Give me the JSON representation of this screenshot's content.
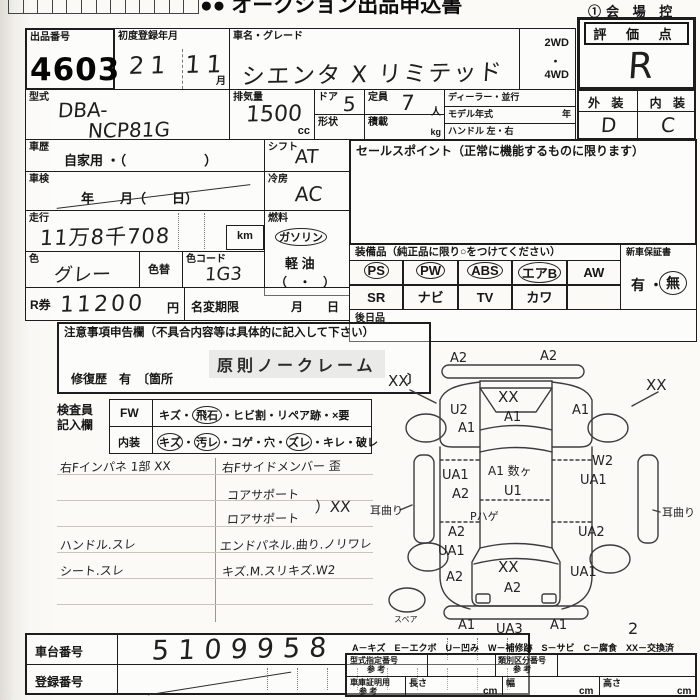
{
  "scan": {
    "logo": "●●",
    "top_title": "オークション出品申込書",
    "copy_label": "①会 場 控"
  },
  "lot": {
    "label": "出品番号",
    "stamp": "4603"
  },
  "first_reg": {
    "label": "初度登録年月",
    "value": "21 11",
    "unit": "月"
  },
  "car_name": {
    "label": "車名・グレード",
    "value": "シエンタ X リミテッド"
  },
  "drive": {
    "l1": "2WD",
    "dot": "・",
    "l2": "4WD"
  },
  "grade": {
    "label": "評 価 点",
    "value": "R"
  },
  "model": {
    "label": "型式",
    "line1": "DBA-",
    "line2": "NCP81G"
  },
  "displacement": {
    "label": "排気量",
    "value": "1500",
    "unit": "cc"
  },
  "door": {
    "label": "ドア",
    "value": "5",
    "shape_label": "形状"
  },
  "capacity": {
    "label": "定員",
    "value": "7",
    "unit": "人",
    "load_label": "積載",
    "load_unit": "kg"
  },
  "dealer": {
    "l1": "ディーラー・並行",
    "l2": "モデル年式",
    "l2u": "年",
    "l3": "ハンドル 左・右"
  },
  "exterior": {
    "label": "外 装",
    "value": "D"
  },
  "interior_grade": {
    "label": "内 装",
    "value": "C"
  },
  "history": {
    "label": "車歴",
    "value": "自家用 ・（　　　　　　）"
  },
  "shift": {
    "label": "シフト",
    "value": "AT"
  },
  "shaken": {
    "label": "車検",
    "value": "年　　月（　　日）"
  },
  "aircon": {
    "label": "冷房",
    "value": "AC"
  },
  "mileage": {
    "label": "走行",
    "value": "11万8千708",
    "unit": "km"
  },
  "fuel": {
    "label": "燃料",
    "gasoline": "ガソリン",
    "diesel": "軽 油",
    "paren": "（　・　）"
  },
  "color": {
    "label": "色",
    "value": "グレー",
    "repaint_label": "色替",
    "code_label": "色コード",
    "code_value": "1G3"
  },
  "r_ticket": {
    "label": "R券",
    "value": "11200",
    "unit": "円"
  },
  "rename": {
    "label": "名変期限",
    "value": "月　　日"
  },
  "sales_point": {
    "label": "セールスポイント（正常に機能するものに限ります）"
  },
  "equipment": {
    "label": "装備品（純正品に限り○をつけてください）",
    "items": [
      "PS",
      "PW",
      "ABS",
      "エアB",
      "AW",
      "SR",
      "ナビ",
      "TV",
      "カワ",
      ""
    ]
  },
  "warranty": {
    "label": "新車保証書",
    "yes": "有",
    "dot": "・",
    "no": "無"
  },
  "later_goods": {
    "label": "後日品"
  },
  "caution": {
    "label": "注意事項申告欄（不具合内容等は具体的に記入して下さい）",
    "stamp": "原則ノークレーム",
    "repair": "修復歴　有　〔箇所",
    "repair_close": "〕"
  },
  "inspector": {
    "label_l1": "検査員",
    "label_l2": "記入欄",
    "fw": "FW",
    "sep": "・",
    "fw_items": [
      "キズ",
      "飛石",
      "ヒビ割",
      "リペア跡",
      "×要"
    ],
    "interior": "内装",
    "interior_items": [
      "キズ",
      "汚レ",
      "コゲ",
      "穴",
      "ズレ",
      "キレ",
      "破レ"
    ]
  },
  "notes": {
    "left": [
      "右Fインパネ 1部 XX",
      "ハンドル.スレ",
      "シート.スレ"
    ],
    "right": [
      "右Fサイドメンバー 歪",
      "コアサポート",
      "ロアサポート",
      "エンドパネル.曲り.ノリワレ",
      "キズ.M.スリキズ.W2"
    ],
    "brace": "）XX"
  },
  "chassis": {
    "label": "車台番号",
    "value": "5109958"
  },
  "plate": {
    "label": "登録番号"
  },
  "legend": "A－キズ　E－エクボ　U－凹み　W－補修跡　S－サビ　C－腐食　XX－交換済",
  "ref_table": {
    "type_label": "型式指定番号",
    "ref": "参 考",
    "class_label": "類別区分番号",
    "garage_label": "車庫証明用",
    "len": "長さ",
    "wid": "幅",
    "hgt": "高さ",
    "cm": "cm"
  },
  "diagram": {
    "front_bumper_l": "A2",
    "front_bumper_r": "A2",
    "xx_l": "XX",
    "xx_r": "XX",
    "lf_fender_1": "U2",
    "lf_fender_2": "A1",
    "hood_1": "XX",
    "hood_2": "A1",
    "rf_fender": "A1",
    "lf_door_1": "UA1",
    "lf_door_2": "A2",
    "roof_1": "A1 数ヶ",
    "roof_2": "U1",
    "roof_3": "Pハゲ",
    "rf_door_1": "W2",
    "rf_door_2": "UA1",
    "lr_door_1": "A2",
    "lr_door_2": "UA1",
    "rr_door": "UA2",
    "l_quarter": "A2",
    "gate_1": "XX",
    "gate_2": "A2",
    "r_quarter": "UA1",
    "rear_bumper_l": "A1",
    "rear_bumper_c": "UA3",
    "rear_bumper_r": "A1",
    "ear_l": "耳曲り",
    "ear_r": "耳曲り",
    "spare": "スペア",
    "page_num": "2"
  }
}
